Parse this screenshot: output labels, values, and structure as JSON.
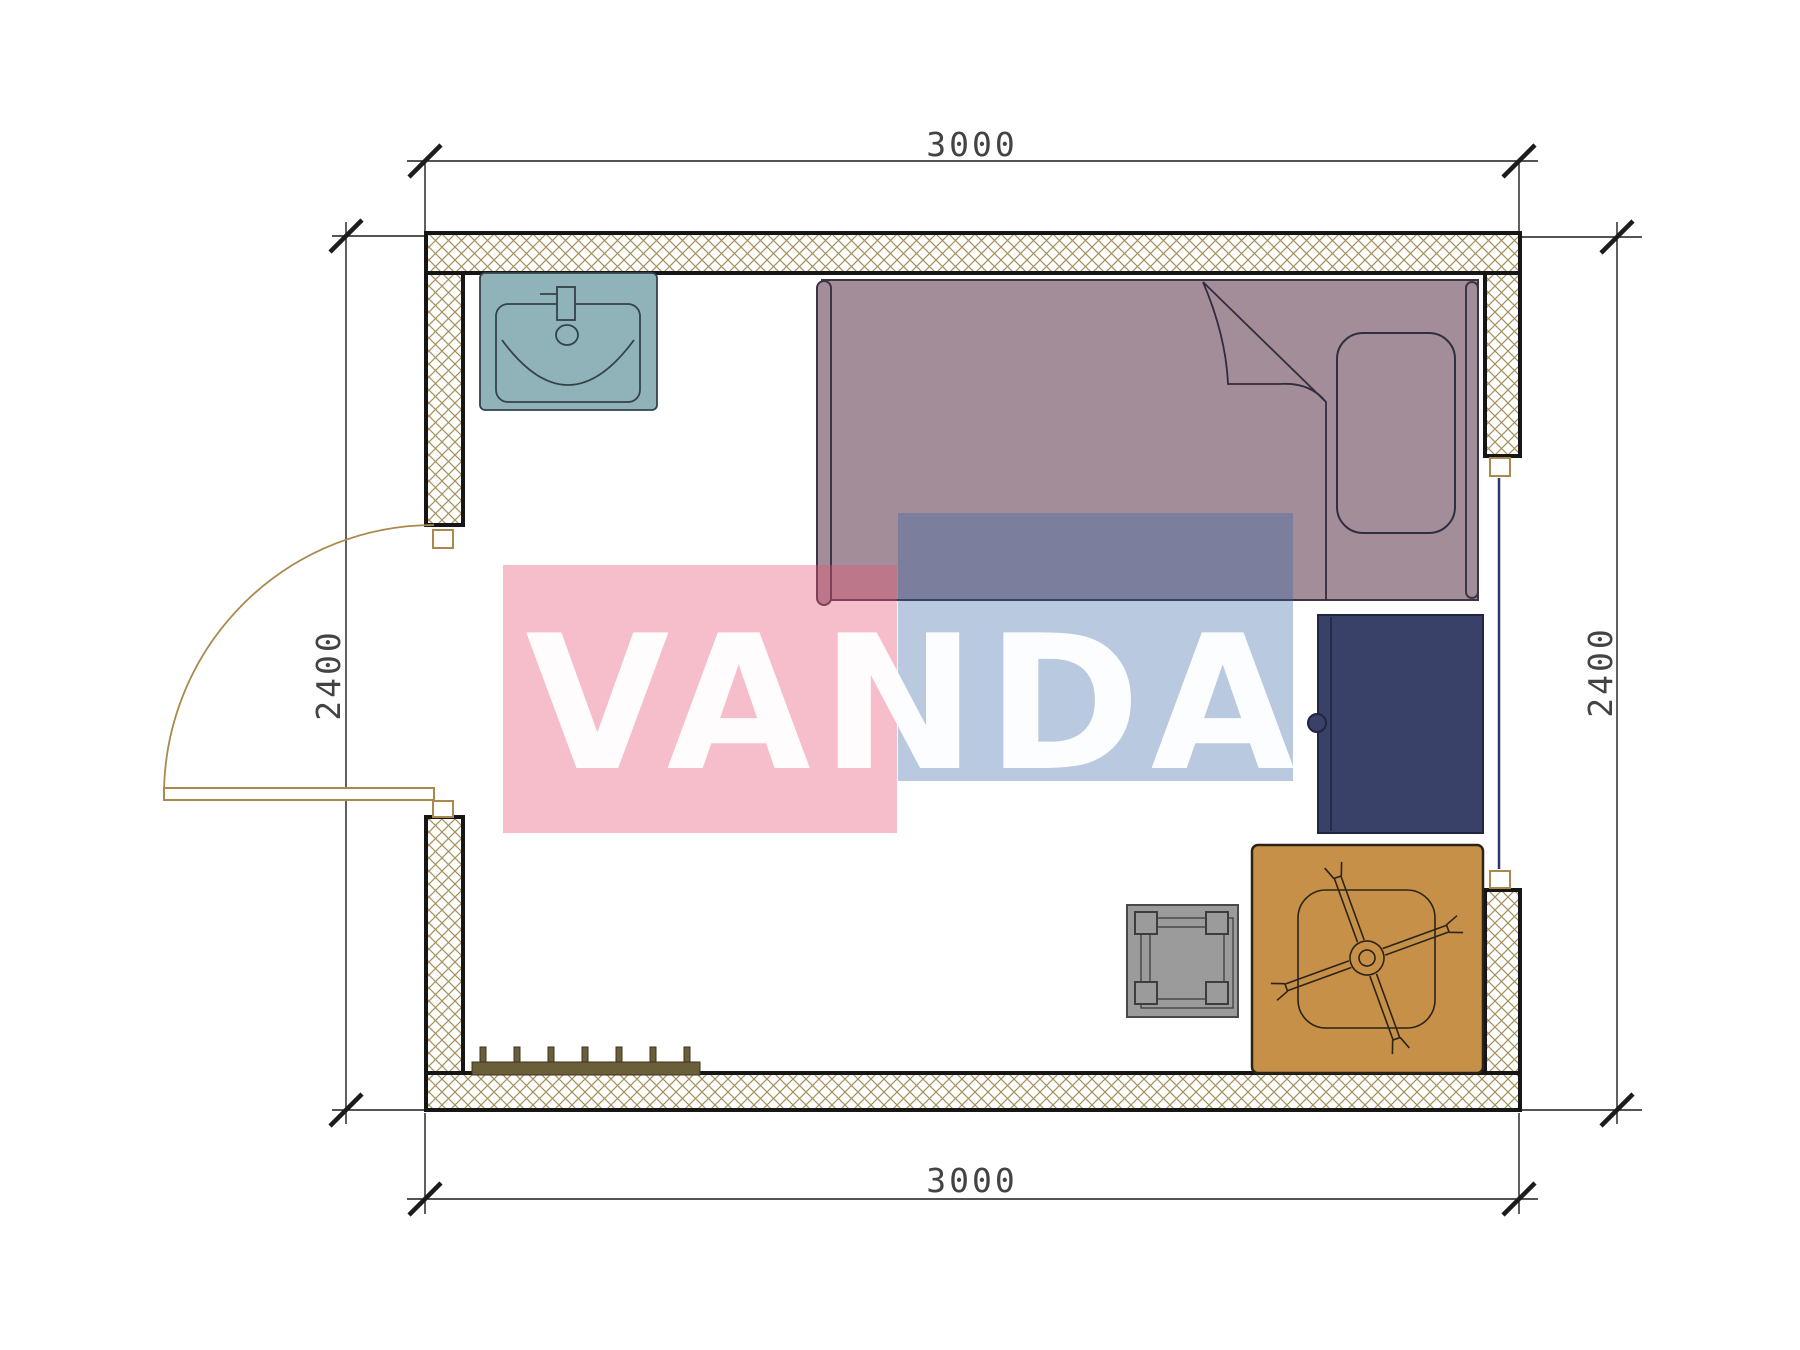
{
  "drawing": {
    "type": "architectural-floor-plan",
    "description": "single room plan with furniture, hatched walls, door swing, window, dimension lines"
  },
  "dimensions": {
    "top": "3000",
    "bottom": "3000",
    "left": "2400",
    "right": "2400"
  },
  "watermark": {
    "text": "VANDA"
  },
  "furniture": [
    {
      "name": "sink",
      "color": "#8fb3b8"
    },
    {
      "name": "bed",
      "color": "#a28d99"
    },
    {
      "name": "wardrobe",
      "color": "#3a4168"
    },
    {
      "name": "table",
      "color": "#c79048"
    },
    {
      "name": "stool",
      "color": "#9b9b9b"
    },
    {
      "name": "coat-rack",
      "color": "#6b5f3a"
    },
    {
      "name": "door",
      "color": "#a9894e"
    }
  ],
  "colors": {
    "wall_hatch": "#a5905a",
    "wall_border": "#161616",
    "dim_line": "#1c1c1c",
    "dim_text": "#2a2a2a",
    "window_line": "#2f3570",
    "wm_pink": "#e85573",
    "wm_pink_opacity": "0.38",
    "wm_blue": "#3261a0",
    "wm_blue_opacity": "0.34",
    "wm_text": "#ffffff"
  }
}
